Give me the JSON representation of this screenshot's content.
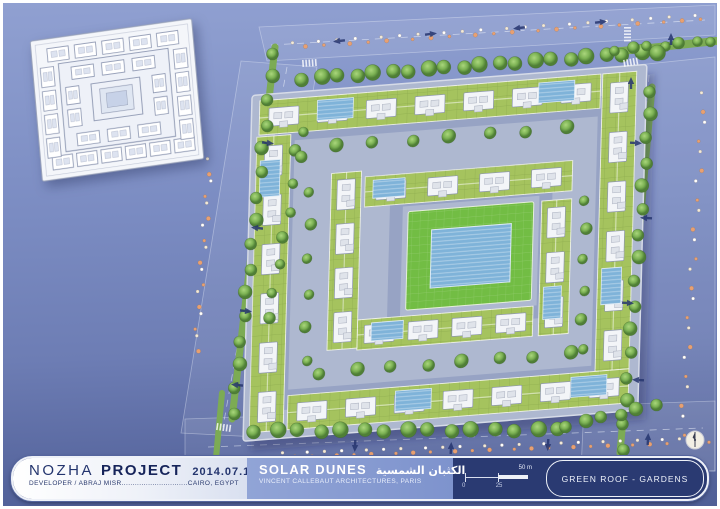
{
  "titlebar": {
    "project_name_outline": "NOZHA",
    "project_name_solid": "PROJECT",
    "date": "2014.07.15",
    "developer_line": "DEVELOPER / ABRAJ MISR..............................CAIRO, EGYPT",
    "scheme_name": "SOLAR DUNES",
    "scheme_name_ar": "الكثبان الشمسية",
    "architect_line": "VINCENT CALLEBAUT ARCHITECTURES, PARIS",
    "sheet_title": "GREEN ROOF - GARDENS",
    "scale": {
      "label_0": "0",
      "label_mid": "25",
      "label_end": "50 m"
    }
  },
  "colors": {
    "road_fill": "rgba(255,255,255,0.07)",
    "road_edge": "rgba(236,240,250,0.40)",
    "lane": "rgba(246,249,255,0.55)",
    "median_green": "#7cab54",
    "site_base": "#aeb8d0",
    "site_edge": "#d6dbe7",
    "ring_road": "#97a3c4",
    "roof_green": "#a5c35e",
    "roof_grid": "rgba(86,116,44,0.30)",
    "court_green": "#72bd44",
    "pool_blue": "#7fb3d9",
    "pool_edge": "#d9e8f4",
    "unit_fill": "#f3f5f8",
    "unit_stroke": "#8d96ad",
    "unit_inner": "#dfe3ea",
    "arrow": "#26356f",
    "palm_a": "#f2ead9",
    "palm_b": "#e8a072",
    "walk_line": "rgba(255,255,255,0.5)"
  },
  "roads": {
    "bands": [
      {
        "pts": "256,24 712,2 712,32 264,58"
      },
      {
        "pts": "238,58 314,64 254,434 178,430"
      },
      {
        "pts": "596,66 712,54 712,468 578,468"
      },
      {
        "pts": "182,416 712,398 712,468 182,466"
      }
    ],
    "lanes": [
      "M268,42 L702,17",
      "M284,64 L220,424",
      "M646,72 L617,456",
      "M205,444 L700,425"
    ],
    "medians": [
      {
        "x1": 272,
        "y1": 44,
        "x2": 229,
        "y2": 416,
        "w": 7
      },
      {
        "x1": 649,
        "y1": 84,
        "x2": 617,
        "y2": 450,
        "w": 7
      },
      {
        "x1": 609,
        "y1": 49,
        "x2": 713,
        "y2": 38,
        "w": 8
      },
      {
        "x1": 219,
        "y1": 390,
        "x2": 213,
        "y2": 455,
        "w": 6
      }
    ]
  },
  "tree_rows": [
    {
      "x1": 300,
      "y1": 76,
      "x2": 638,
      "y2": 50,
      "n": 20,
      "r": 7
    },
    {
      "x1": 271,
      "y1": 50,
      "x2": 230,
      "y2": 410,
      "n": 16,
      "r": 6
    },
    {
      "x1": 648,
      "y1": 88,
      "x2": 619,
      "y2": 446,
      "n": 16,
      "r": 6
    },
    {
      "x1": 252,
      "y1": 428,
      "x2": 556,
      "y2": 427,
      "n": 15,
      "r": 7
    },
    {
      "x1": 564,
      "y1": 423,
      "x2": 652,
      "y2": 403,
      "n": 6,
      "r": 6
    },
    {
      "x1": 613,
      "y1": 47,
      "x2": 709,
      "y2": 38,
      "n": 7,
      "r": 5
    },
    {
      "x1": 302,
      "y1": 128,
      "x2": 265,
      "y2": 316,
      "n": 8,
      "r": 5
    },
    {
      "x1": 656,
      "y1": 49,
      "x2": 656,
      "y2": 49,
      "n": 1,
      "r": 8
    }
  ],
  "palm_rows": [
    {
      "x1": 292,
      "y1": 42,
      "x2": 700,
      "y2": 14,
      "n": 40
    },
    {
      "x1": 282,
      "y1": 452,
      "x2": 706,
      "y2": 437,
      "n": 44
    },
    {
      "x1": 207,
      "y1": 158,
      "x2": 193,
      "y2": 346,
      "n": 18
    },
    {
      "x1": 701,
      "y1": 92,
      "x2": 679,
      "y2": 430,
      "n": 24
    }
  ],
  "arrows": [
    [
      336,
      38,
      263
    ],
    [
      428,
      31,
      83
    ],
    [
      516,
      25,
      263
    ],
    [
      598,
      19,
      83
    ],
    [
      265,
      140,
      96
    ],
    [
      254,
      225,
      276
    ],
    [
      243,
      308,
      96
    ],
    [
      234,
      382,
      276
    ],
    [
      633,
      140,
      93
    ],
    [
      643,
      215,
      273
    ],
    [
      625,
      300,
      93
    ],
    [
      635,
      377,
      273
    ],
    [
      352,
      443,
      183
    ],
    [
      448,
      445,
      3
    ],
    [
      545,
      442,
      183
    ],
    [
      645,
      436,
      3
    ],
    [
      628,
      80,
      0
    ],
    [
      668,
      36,
      0
    ]
  ],
  "crosswalks": [
    {
      "x": 299,
      "y": 57,
      "r": -4
    },
    {
      "x": 214,
      "y": 420,
      "r": 8
    },
    {
      "x": 620,
      "y": 57,
      "r": -10
    },
    {
      "x": 628,
      "y": 24,
      "r": 90
    }
  ],
  "site": {
    "cx": 440,
    "cy": 248,
    "rot": -4.5,
    "skew": -6,
    "base": {
      "x": -196,
      "y": -170,
      "w": 396,
      "h": 344
    },
    "ring_outer": {
      "x": -162,
      "y": -132,
      "w": 324,
      "h": 268,
      "sw": 20
    },
    "ring_inner": {
      "x": -48,
      "y": -54,
      "w": 150,
      "h": 122,
      "sw": 13
    },
    "bars": [
      {
        "x": -188,
        "y": -164,
        "w": 342,
        "h": 34,
        "o": "h"
      },
      {
        "x": 156,
        "y": -164,
        "w": 34,
        "h": 296,
        "o": "v"
      },
      {
        "x": -152,
        "y": 132,
        "w": 342,
        "h": 34,
        "o": "h"
      },
      {
        "x": -190,
        "y": -128,
        "w": 34,
        "h": 294,
        "o": "v"
      },
      {
        "x": -80,
        "y": -80,
        "w": 208,
        "h": 30,
        "o": "h"
      },
      {
        "x": 98,
        "y": -42,
        "w": 30,
        "h": 134,
        "o": "v"
      },
      {
        "x": -84,
        "y": 62,
        "w": 176,
        "h": 30,
        "o": "h"
      },
      {
        "x": -114,
        "y": -86,
        "w": 30,
        "h": 176,
        "o": "v"
      }
    ],
    "pools": [
      {
        "x": -130,
        "y": -160,
        "w": 36,
        "h": 20
      },
      {
        "x": 92,
        "y": -160,
        "w": 36,
        "h": 20
      },
      {
        "x": 160,
        "y": 30,
        "w": 20,
        "h": 36
      },
      {
        "x": 132,
        "y": 136,
        "w": 36,
        "h": 20
      },
      {
        "x": -186,
        "y": -104,
        "w": 20,
        "h": 36
      },
      {
        "x": -72,
        "y": -76,
        "w": 32,
        "h": 18
      },
      {
        "x": 102,
        "y": 44,
        "w": 18,
        "h": 32
      },
      {
        "x": -70,
        "y": 66,
        "w": 32,
        "h": 18
      },
      {
        "x": -44,
        "y": 136,
        "w": 36,
        "h": 20
      }
    ],
    "courtyard": {
      "x": -36,
      "y": -42,
      "w": 126,
      "h": 98
    },
    "court_pool": {
      "x": -12,
      "y": -22,
      "w": 80,
      "h": 58
    },
    "tree_rows": [
      {
        "x1": -150,
        "y1": -113,
        "x2": 120,
        "y2": -113,
        "n": 8,
        "r": 6
      },
      {
        "x1": 142,
        "y1": -40,
        "x2": 142,
        "y2": 110,
        "n": 6,
        "r": 5
      },
      {
        "x1": -120,
        "y1": 112,
        "x2": 130,
        "y2": 112,
        "n": 8,
        "r": 6
      },
      {
        "x1": -135,
        "y1": -70,
        "x2": -135,
        "y2": 100,
        "n": 6,
        "r": 5
      }
    ]
  },
  "inset": {
    "units_top": 5,
    "units_bottom": 6,
    "units_left": 4,
    "units_right": 4,
    "inner_top": 3,
    "inner_bottom": 3,
    "inner_sides": 2
  },
  "north_arrow": {
    "r": 9
  }
}
